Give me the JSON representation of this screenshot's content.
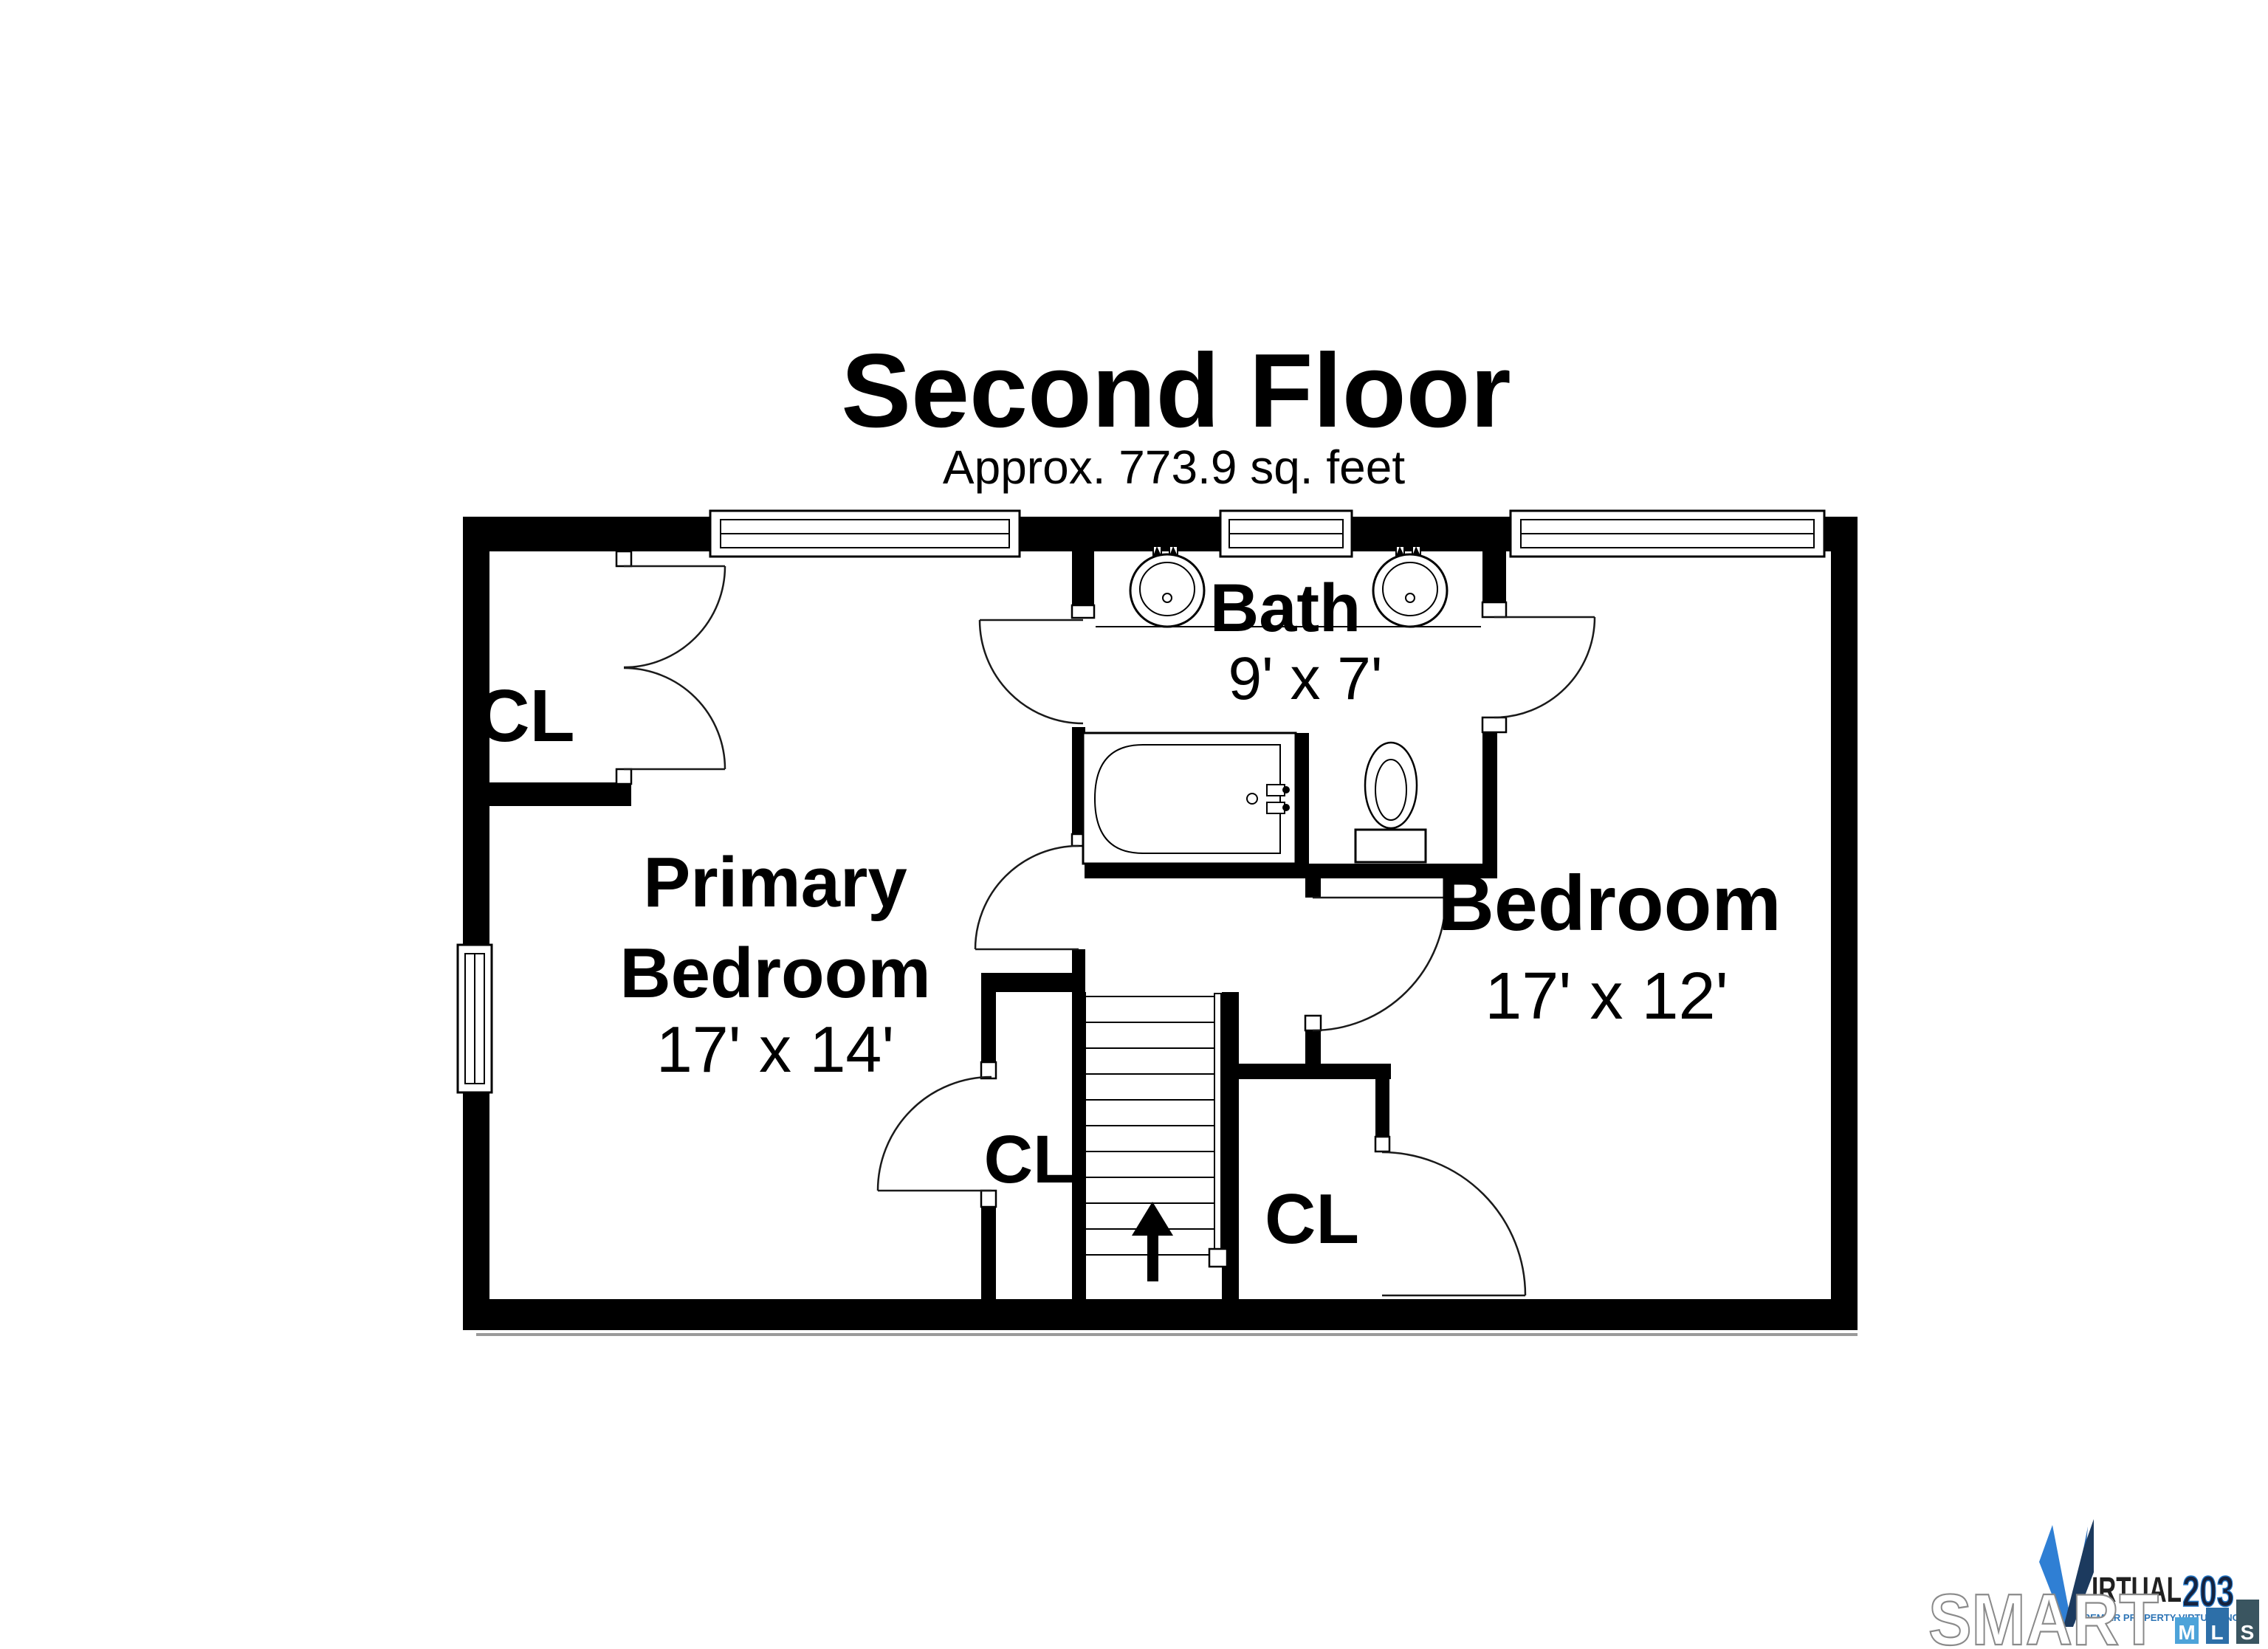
{
  "header": {
    "title": "Second Floor",
    "subtitle": "Approx. 773.9 sq. feet"
  },
  "rooms": {
    "bath": {
      "name": "Bath",
      "dims": "9' x 7'"
    },
    "primary_bedroom": {
      "name_line1": "Primary",
      "name_line2": "Bedroom",
      "dims": "17' x 14'"
    },
    "bedroom": {
      "name": "Bedroom",
      "dims": "17' x 12'"
    },
    "closet_top_left": {
      "label": "CL"
    },
    "closet_lower_left": {
      "label": "CL"
    },
    "closet_lower_right": {
      "label": "CL"
    }
  },
  "stairs": {
    "direction": "up"
  },
  "fixtures": [
    "double-sink-vanity",
    "bathtub",
    "toilet"
  ],
  "branding": {
    "smartmls": {
      "wordmark": "SMART",
      "boxes": [
        {
          "letter": "M",
          "color": "#4da3d9"
        },
        {
          "letter": "L",
          "color": "#2d6fa8"
        },
        {
          "letter": "S",
          "color": "#3a5560"
        }
      ]
    },
    "virtual203": {
      "name_after_v": "IRTUAL",
      "number": "203",
      "tagline": "PREMIER PROPERTY VIRTUAL INC"
    }
  },
  "colors": {
    "walls": "#000000",
    "v_light_blue": "#2f7fd4",
    "v_navy": "#1c3a5e",
    "number_navy": "#16233f",
    "number_blue": "#2478c8",
    "tagline_blue": "#2e75b6",
    "smart_outline": "#8a8a8a"
  }
}
